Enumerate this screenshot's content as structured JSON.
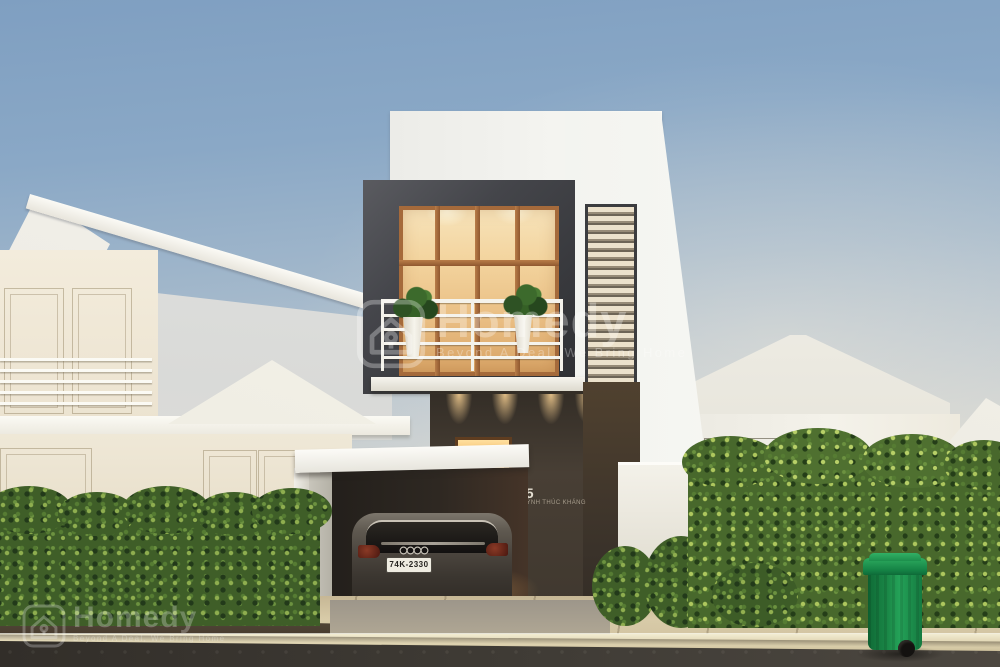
{
  "watermark": {
    "brand": "Homedy",
    "tagline": "Beyond A Deal, We Bring Home",
    "logo_icon": "homedy-house-keyhole-icon",
    "color": "#ffffff"
  },
  "house_sign": {
    "number": "05",
    "street_name": "HUỲNH THÚC KHÁNG"
  },
  "vehicle": {
    "license_plate": "74K-2330",
    "badge_icon": "audi-rings-icon"
  },
  "colors": {
    "sky_top": "#7f9fc1",
    "sky_horizon": "#d8d8d2",
    "wall_white": "#f4f3ee",
    "cream_wall": "#f0e8d8",
    "frame_dark": "#3e3f42",
    "window_glow": "#f3d49e",
    "wood_frame": "#a56a3b",
    "hedge_green": "#3f5e28",
    "hedge_highlight": "#a9c35e",
    "bin": "#24a258",
    "road": "#322e29",
    "sidewalk": "#d8cba8",
    "car_body": "#4a443d"
  }
}
